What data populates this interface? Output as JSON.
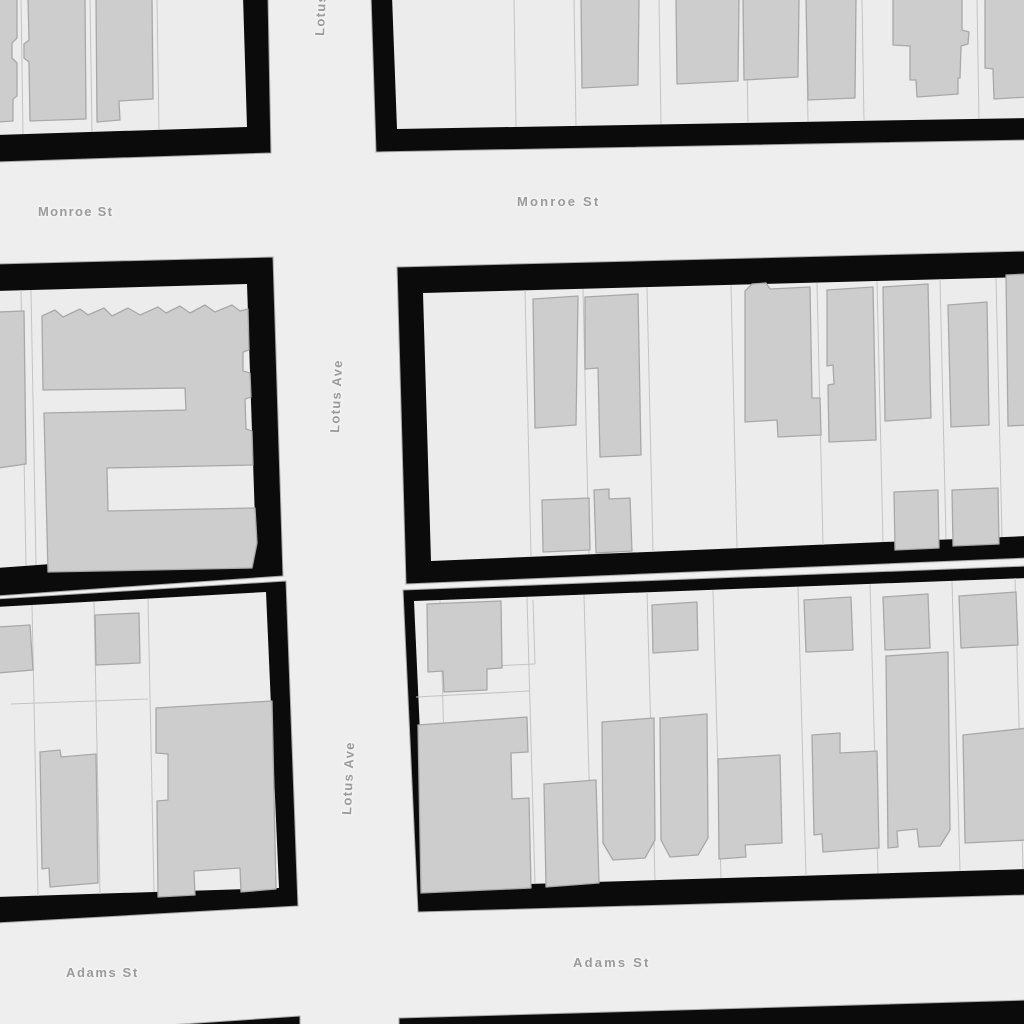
{
  "map": {
    "type": "street-map-grayscale",
    "streets": [
      "Monroe St",
      "Lotus Ave",
      "Adams St"
    ],
    "street_labels": {
      "monroe_st_left": "Monroe St",
      "monroe_st_right": "Monroe St",
      "lotus_ave_top": "Lotus Ave",
      "lotus_ave_middle": "Lotus Ave",
      "lotus_ave_lower": "Lotus Ave",
      "adams_st_left": "Adams St",
      "adams_st_right": "Adams St"
    },
    "theme": {
      "street_color": "#eeeeee",
      "parcel_color": "#ececec",
      "building_color": "#cdcdcd",
      "building_outline_color": "#a8a8a8",
      "block_border_color": "#0b0b0b",
      "block_outline_color": "#a8a8a8",
      "label_color": "#9b9b9b",
      "label_halo_color": "#f2f2f2"
    }
  }
}
